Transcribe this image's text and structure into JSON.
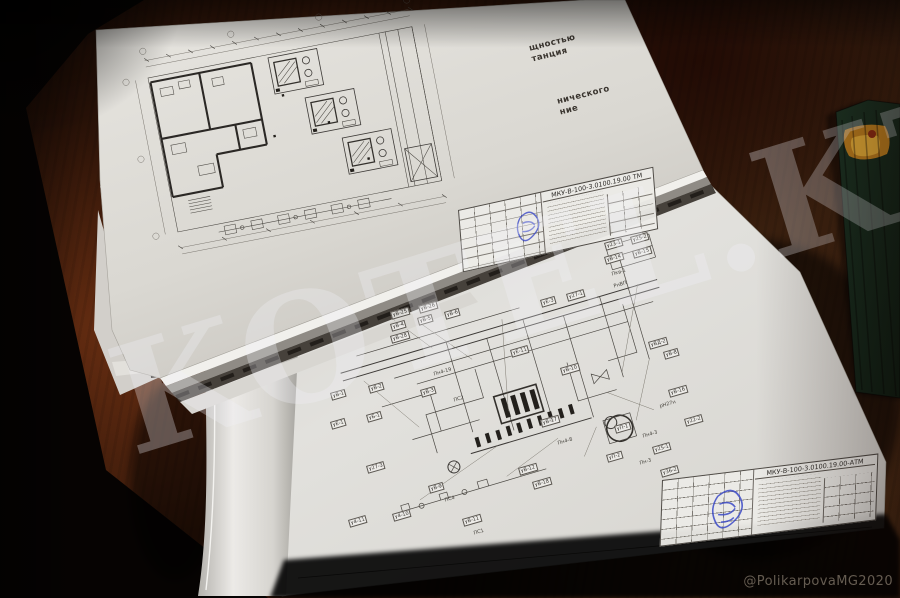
{
  "photo": {
    "watermark": "KOTEL.KZ",
    "credit": "@PolikarpovaMG2020"
  },
  "top_sheet": {
    "edge_text_block1": [
      "щностью",
      "танция"
    ],
    "edge_text_block2": [
      "нического",
      "ние"
    ],
    "title_block": {
      "code": "МКУ-В-100-3.0100.19.00 ТМ"
    }
  },
  "bottom_sheet": {
    "title_block": {
      "code": "МКУ-В-100-3.0100.19.00-АТМ"
    },
    "label_rotation_deg": -16,
    "labels": [
      {
        "x": 390,
        "y": 312,
        "t": "уВ-25"
      },
      {
        "x": 418,
        "y": 306,
        "t": "уВ-26"
      },
      {
        "x": 390,
        "y": 324,
        "t": "уВ-4"
      },
      {
        "x": 417,
        "y": 318,
        "t": "уВ-5"
      },
      {
        "x": 444,
        "y": 312,
        "t": "уВ-6"
      },
      {
        "x": 390,
        "y": 336,
        "t": "уВ-28"
      },
      {
        "x": 540,
        "y": 300,
        "t": "уЕ-3"
      },
      {
        "x": 566,
        "y": 294,
        "t": "у27-1"
      },
      {
        "x": 604,
        "y": 243,
        "t": "у23-1"
      },
      {
        "x": 630,
        "y": 237,
        "t": "у25-2"
      },
      {
        "x": 604,
        "y": 257,
        "t": "уВ-14"
      },
      {
        "x": 632,
        "y": 251,
        "t": "уВ-15"
      },
      {
        "x": 610,
        "y": 272,
        "t": "Пкв-1",
        "p": 1
      },
      {
        "x": 612,
        "y": 284,
        "t": "РнВП",
        "p": 1
      },
      {
        "x": 648,
        "y": 342,
        "t": "уВД-2"
      },
      {
        "x": 663,
        "y": 352,
        "t": "уВ-8"
      },
      {
        "x": 330,
        "y": 393,
        "t": "уВ-1"
      },
      {
        "x": 368,
        "y": 386,
        "t": "уВ-2"
      },
      {
        "x": 330,
        "y": 422,
        "t": "уЕ-1"
      },
      {
        "x": 366,
        "y": 415,
        "t": "уБ-1"
      },
      {
        "x": 420,
        "y": 390,
        "t": "уВ-3"
      },
      {
        "x": 432,
        "y": 372,
        "t": "Пн4-19",
        "p": 1
      },
      {
        "x": 452,
        "y": 398,
        "t": "ПС2",
        "p": 1
      },
      {
        "x": 510,
        "y": 350,
        "t": "уЕ-11"
      },
      {
        "x": 560,
        "y": 368,
        "t": "уВ-10"
      },
      {
        "x": 540,
        "y": 420,
        "t": "уВ-17"
      },
      {
        "x": 556,
        "y": 441,
        "t": "Пн4-8",
        "p": 1
      },
      {
        "x": 614,
        "y": 426,
        "t": "уП-1"
      },
      {
        "x": 641,
        "y": 434,
        "t": "Пн4-3",
        "p": 1
      },
      {
        "x": 652,
        "y": 447,
        "t": "у25-1"
      },
      {
        "x": 638,
        "y": 461,
        "t": "Пн-3",
        "p": 1
      },
      {
        "x": 668,
        "y": 390,
        "t": "уВ-16"
      },
      {
        "x": 658,
        "y": 404,
        "t": "рН27н",
        "p": 1
      },
      {
        "x": 366,
        "y": 466,
        "t": "у27-3"
      },
      {
        "x": 428,
        "y": 486,
        "t": "уВ-9"
      },
      {
        "x": 443,
        "y": 498,
        "t": "ПС4",
        "p": 1
      },
      {
        "x": 518,
        "y": 468,
        "t": "уВ-12"
      },
      {
        "x": 532,
        "y": 482,
        "t": "уВ-18"
      },
      {
        "x": 462,
        "y": 519,
        "t": "уВ-11"
      },
      {
        "x": 472,
        "y": 531,
        "t": "ПС1",
        "p": 1
      },
      {
        "x": 348,
        "y": 520,
        "t": "у4-11"
      },
      {
        "x": 392,
        "y": 514,
        "t": "у4-10"
      },
      {
        "x": 606,
        "y": 455,
        "t": "уП-2"
      },
      {
        "x": 684,
        "y": 419,
        "t": "у22-2"
      },
      {
        "x": 660,
        "y": 470,
        "t": "у36-2"
      }
    ]
  }
}
